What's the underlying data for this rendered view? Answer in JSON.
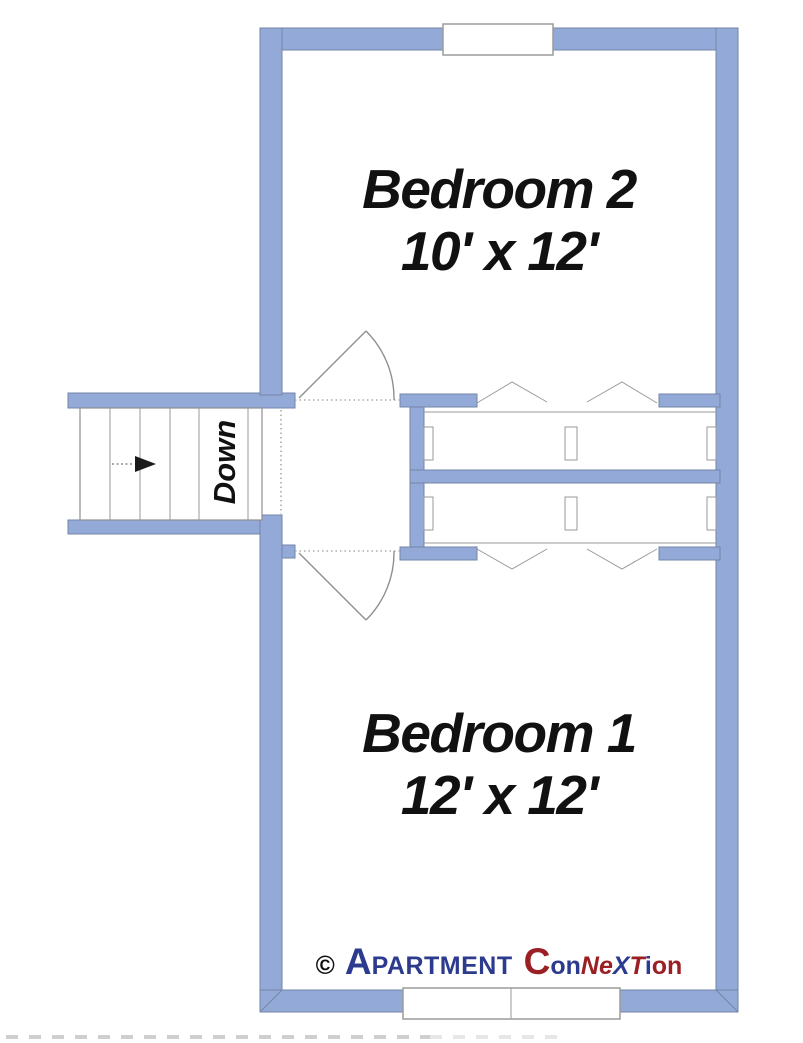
{
  "colors": {
    "wall_fill": "#93A9D8",
    "wall_outline": "#7385A6",
    "plan_line_gray": "#8F8F8F",
    "text_black": "#111111",
    "logo_navy": "#2C3B8E",
    "logo_maroon": "#9A2025"
  },
  "floorplan": {
    "rooms": [
      {
        "name": "Bedroom 2",
        "dimensions": "10' x 12'"
      },
      {
        "name": "Bedroom 1",
        "dimensions": "12' x 12'"
      }
    ],
    "stairs": {
      "label": "Down",
      "arrow_icon": "right-arrow"
    },
    "closets": {
      "door_style": "bifold-chevron",
      "count": 2
    }
  },
  "logo": {
    "parts": [
      {
        "text": "©",
        "style": "color:#111111;font-size:26px;font-style:normal;margin-right:10px"
      },
      {
        "text": "A",
        "style": "color:#2C3B8E;font-size:37px"
      },
      {
        "text": "PARTMENT",
        "style": "color:#2C3B8E;font-size:25px;letter-spacing:0.5px"
      },
      {
        "text": "C",
        "style": "color:#9A2025;font-size:37px;margin-left:11px"
      },
      {
        "text": "on",
        "style": "color:#2C3B8E;font-size:25px"
      },
      {
        "text": "Ne",
        "style": "color:#9A2025;font-size:25px;font-style:italic"
      },
      {
        "text": "X",
        "style": "color:#2C3B8E;font-size:25px;font-style:italic"
      },
      {
        "text": "T",
        "style": "color:#9A2025;font-size:25px;font-style:italic"
      },
      {
        "text": "i",
        "style": "color:#2C3B8E;font-size:25px"
      },
      {
        "text": "on",
        "style": "color:#9A2025;font-size:25px"
      }
    ]
  }
}
